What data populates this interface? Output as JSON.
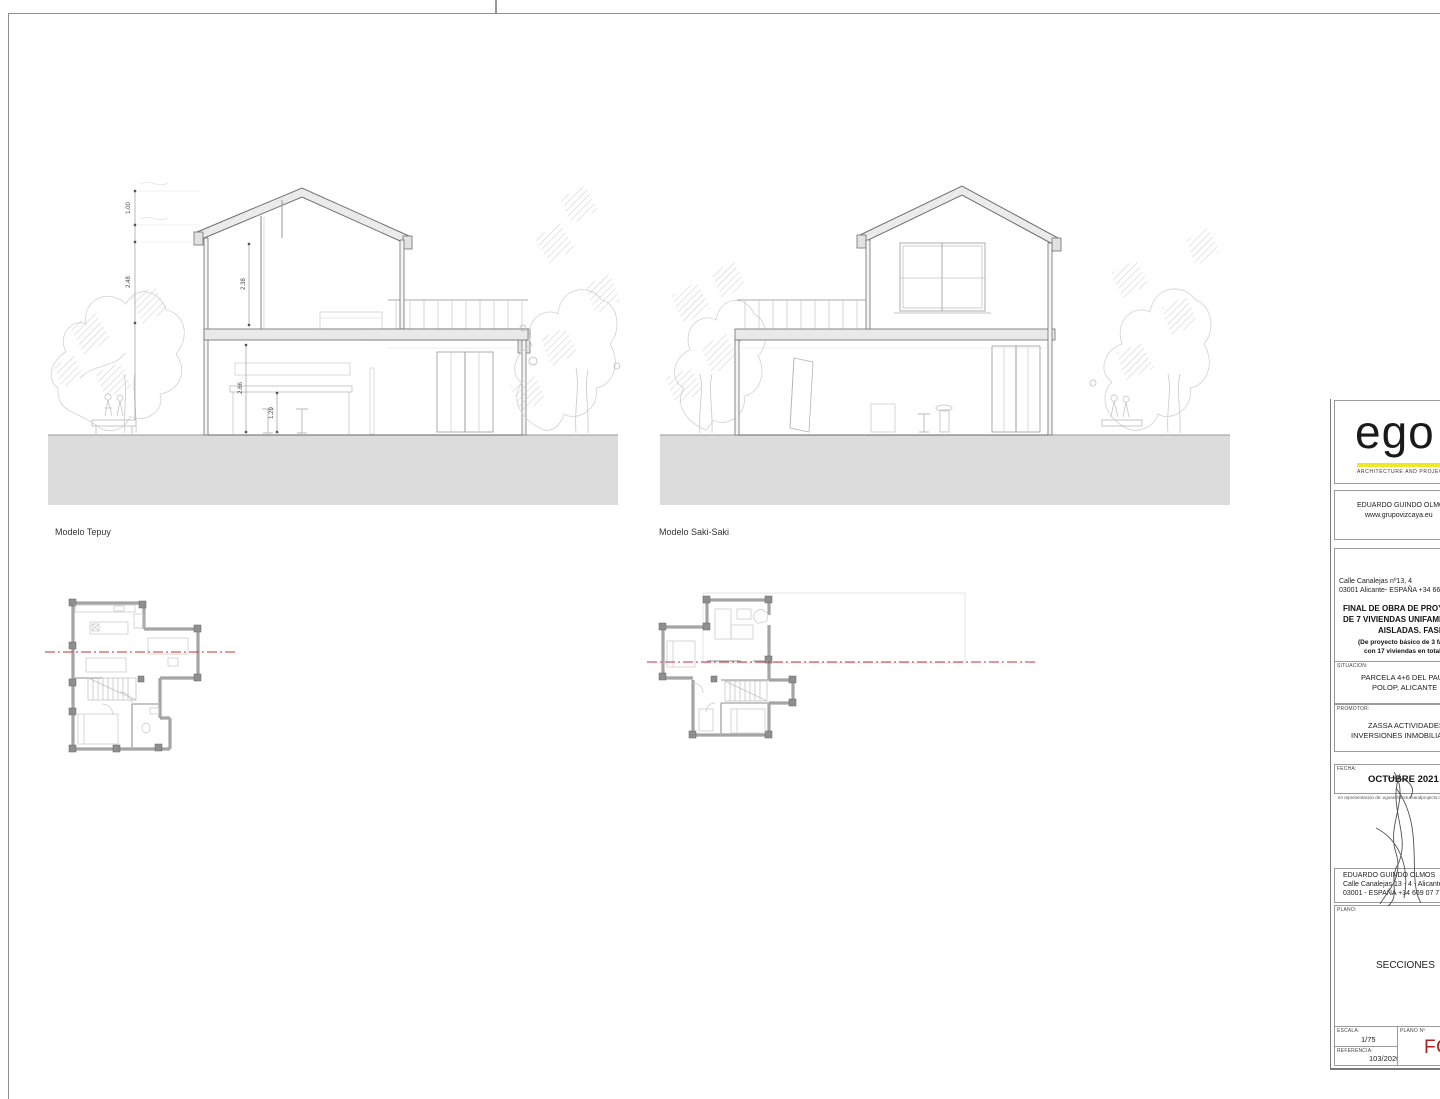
{
  "sections": [
    {
      "label": "Modelo Tepuy",
      "dims": {
        "d1": "1.00",
        "d2": "2.48",
        "d3": "2.38",
        "d4": "2.66",
        "d5": "1.20"
      }
    },
    {
      "label": "Modelo Saki-Saki"
    }
  ],
  "titleblock": {
    "logo": {
      "text": "ego",
      "tagline": "ARCHITECTURE AND PROJECT",
      "accent": "#f0e62a"
    },
    "firm": {
      "name": "EDUARDO GUINDO OLMOS",
      "web": "www.grupovizcaya.eu"
    },
    "address": {
      "line1": "Calle Canalejas nº13, 4",
      "line2": "03001 Alicante- ESPAÑA +34 669 07"
    },
    "project": {
      "line1": "FINAL DE OBRA DE PROYE",
      "line2": "DE 7 VIVIENDAS UNIFAMILI",
      "line3": "AISLADAS. FASE 1",
      "sub1": "(De proyecto básico de 3 fas",
      "sub2": "con 17 viviendas en total)"
    },
    "situacion": {
      "label": "SITUACION:",
      "line1": "PARCELA 4+6 DEL PAU-1",
      "line2": "POLOP, ALICANTE"
    },
    "promotor": {
      "label": "PROMOTOR:",
      "line1": "ZASSA ACTIVIDADES E",
      "line2": "INVERSIONES INMOBILIARI"
    },
    "fecha": {
      "label": "FECHA:",
      "value": "OCTUBRE 2021",
      "rep": "en representación de: egoarchitectureandprojects.c"
    },
    "architect": {
      "name": "EDUARDO GUINDO OLMOS",
      "addr1": "Calle Canalejas 13 - 4 - Alicante",
      "addr2": "03001 - ESPAÑA +34 669 07 77 66"
    },
    "plano": {
      "label": "PLANO:",
      "value": "SECCIONES"
    },
    "escala": {
      "label": "ESCALA:",
      "value": "1/75"
    },
    "plano_n": {
      "label": "PLANO Nº",
      "value": "FO-",
      "color": "#b02020"
    },
    "referencia": {
      "label": "REFERENCIA:",
      "value": "103/2020"
    }
  }
}
